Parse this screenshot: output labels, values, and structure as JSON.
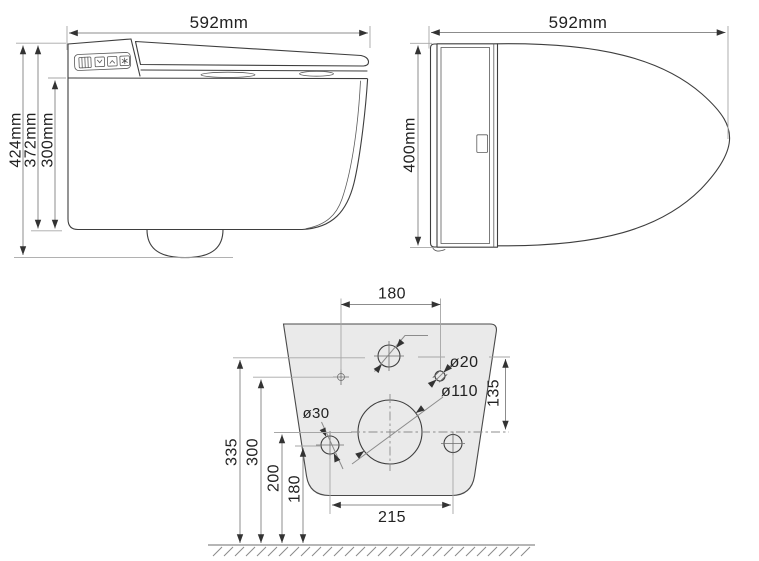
{
  "side_view": {
    "width_label": "592mm",
    "height_total_label": "424mm",
    "height_body_label": "372mm",
    "height_seat_label": "300mm"
  },
  "top_view": {
    "length_label": "592mm",
    "width_label": "400mm"
  },
  "wall_template": {
    "top_holes_spacing_label": "180",
    "dia_20_label": "ø20",
    "dim_135_label": "135",
    "dia_110_label": "ø110",
    "dia_30_label": "ø30",
    "height_335_label": "335",
    "height_300_label": "300",
    "height_200_label": "200",
    "height_180_label": "180",
    "bottom_holes_spacing_label": "215"
  },
  "colors": {
    "outline": "#3e3e3e",
    "dimension_line": "#8c8c8c",
    "arrow": "#333333",
    "text": "#222222",
    "plate_fill": "#eaeaea",
    "ground": "#8a8a8a"
  }
}
